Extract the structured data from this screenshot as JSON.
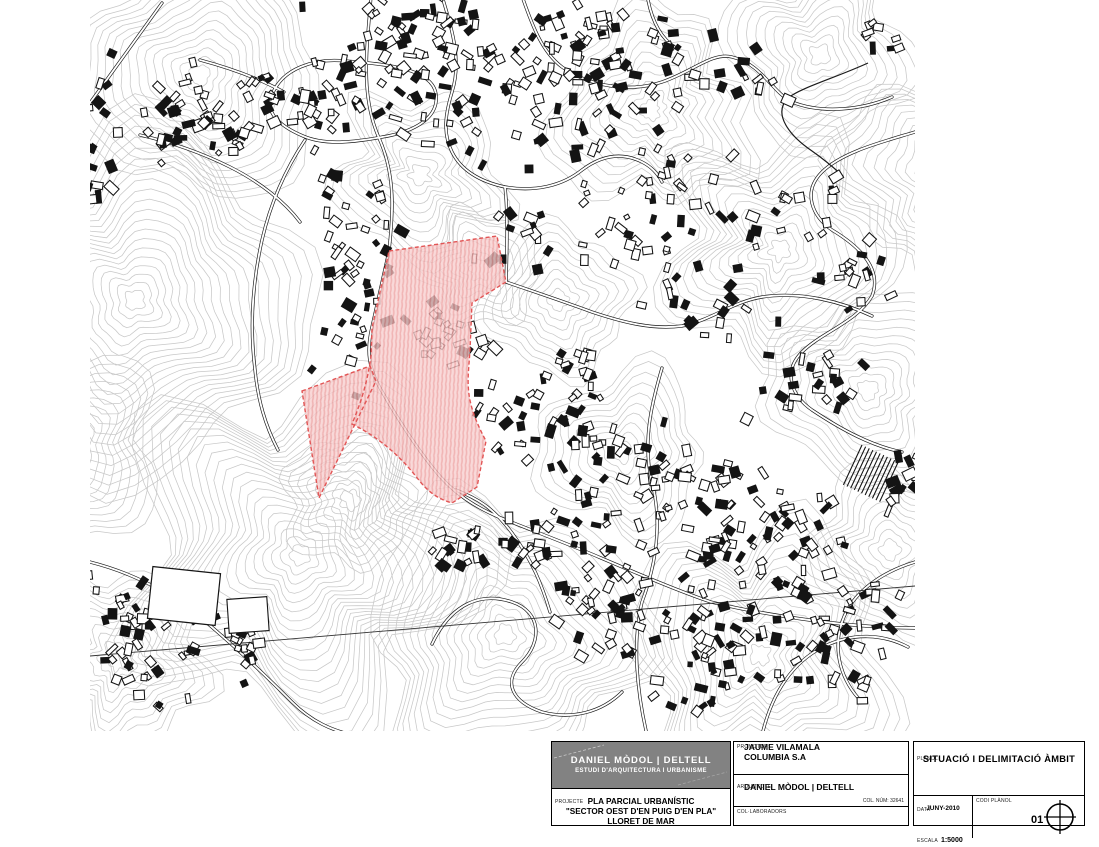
{
  "titleblock": {
    "studio": {
      "name": "DANIEL MÒDOL | DELTELL",
      "subtitle": "ESTUDI D'ARQUITECTURA I URBANISME"
    },
    "projecte": {
      "label": "PROJECTE",
      "line1": "PLA PARCIAL URBANÍSTIC",
      "line2": "\"SECTOR OEST D'EN PUIG D'EN PLA\"",
      "line3": "LLORET DE MAR"
    },
    "promotor": {
      "label": "PROMOTOR:",
      "line1": "JAUME VILAMALA",
      "line2": "COLUMBIA S.A"
    },
    "arquitecte": {
      "label": "ARQUITECTE",
      "name": "DANIEL MÒDOL | DELTELL",
      "col_num": "COL. NÚM: 32641"
    },
    "collaboradors": {
      "label": "COL·LABORADORS"
    },
    "planol": {
      "label": "PLÀNOL",
      "title": "SITUACIÓ I DELIMITACIÓ ÀMBIT"
    },
    "data": {
      "label": "DATA",
      "value": "JUNY-2010"
    },
    "escala": {
      "label": "ESCALA",
      "value": "1:5000"
    },
    "codi_planol": {
      "label": "CODI PLÀNOL",
      "value": "01"
    },
    "compass_icon": "north-compass"
  },
  "map": {
    "colors": {
      "contour": "#c8c8c8",
      "line": "#141414",
      "road_fill": "#ffffff",
      "highlight_fill": "#f8d0d0",
      "highlight_hatch": "#eda2a2",
      "highlight_stroke": "#e25555"
    },
    "highlight_main_path": "M389,251 L497,236 L506,282 L472,303 L470,350 C468,382 463,398 486,441 L477,487 L452,503 C438,499 428,492 418,479 C404,461 384,440 352,424 C359,407 367,386 371,356 L372,328 Z",
    "highlight_triangle_path": "M302,391 L370,366 L376,381 L319,498 Z"
  }
}
